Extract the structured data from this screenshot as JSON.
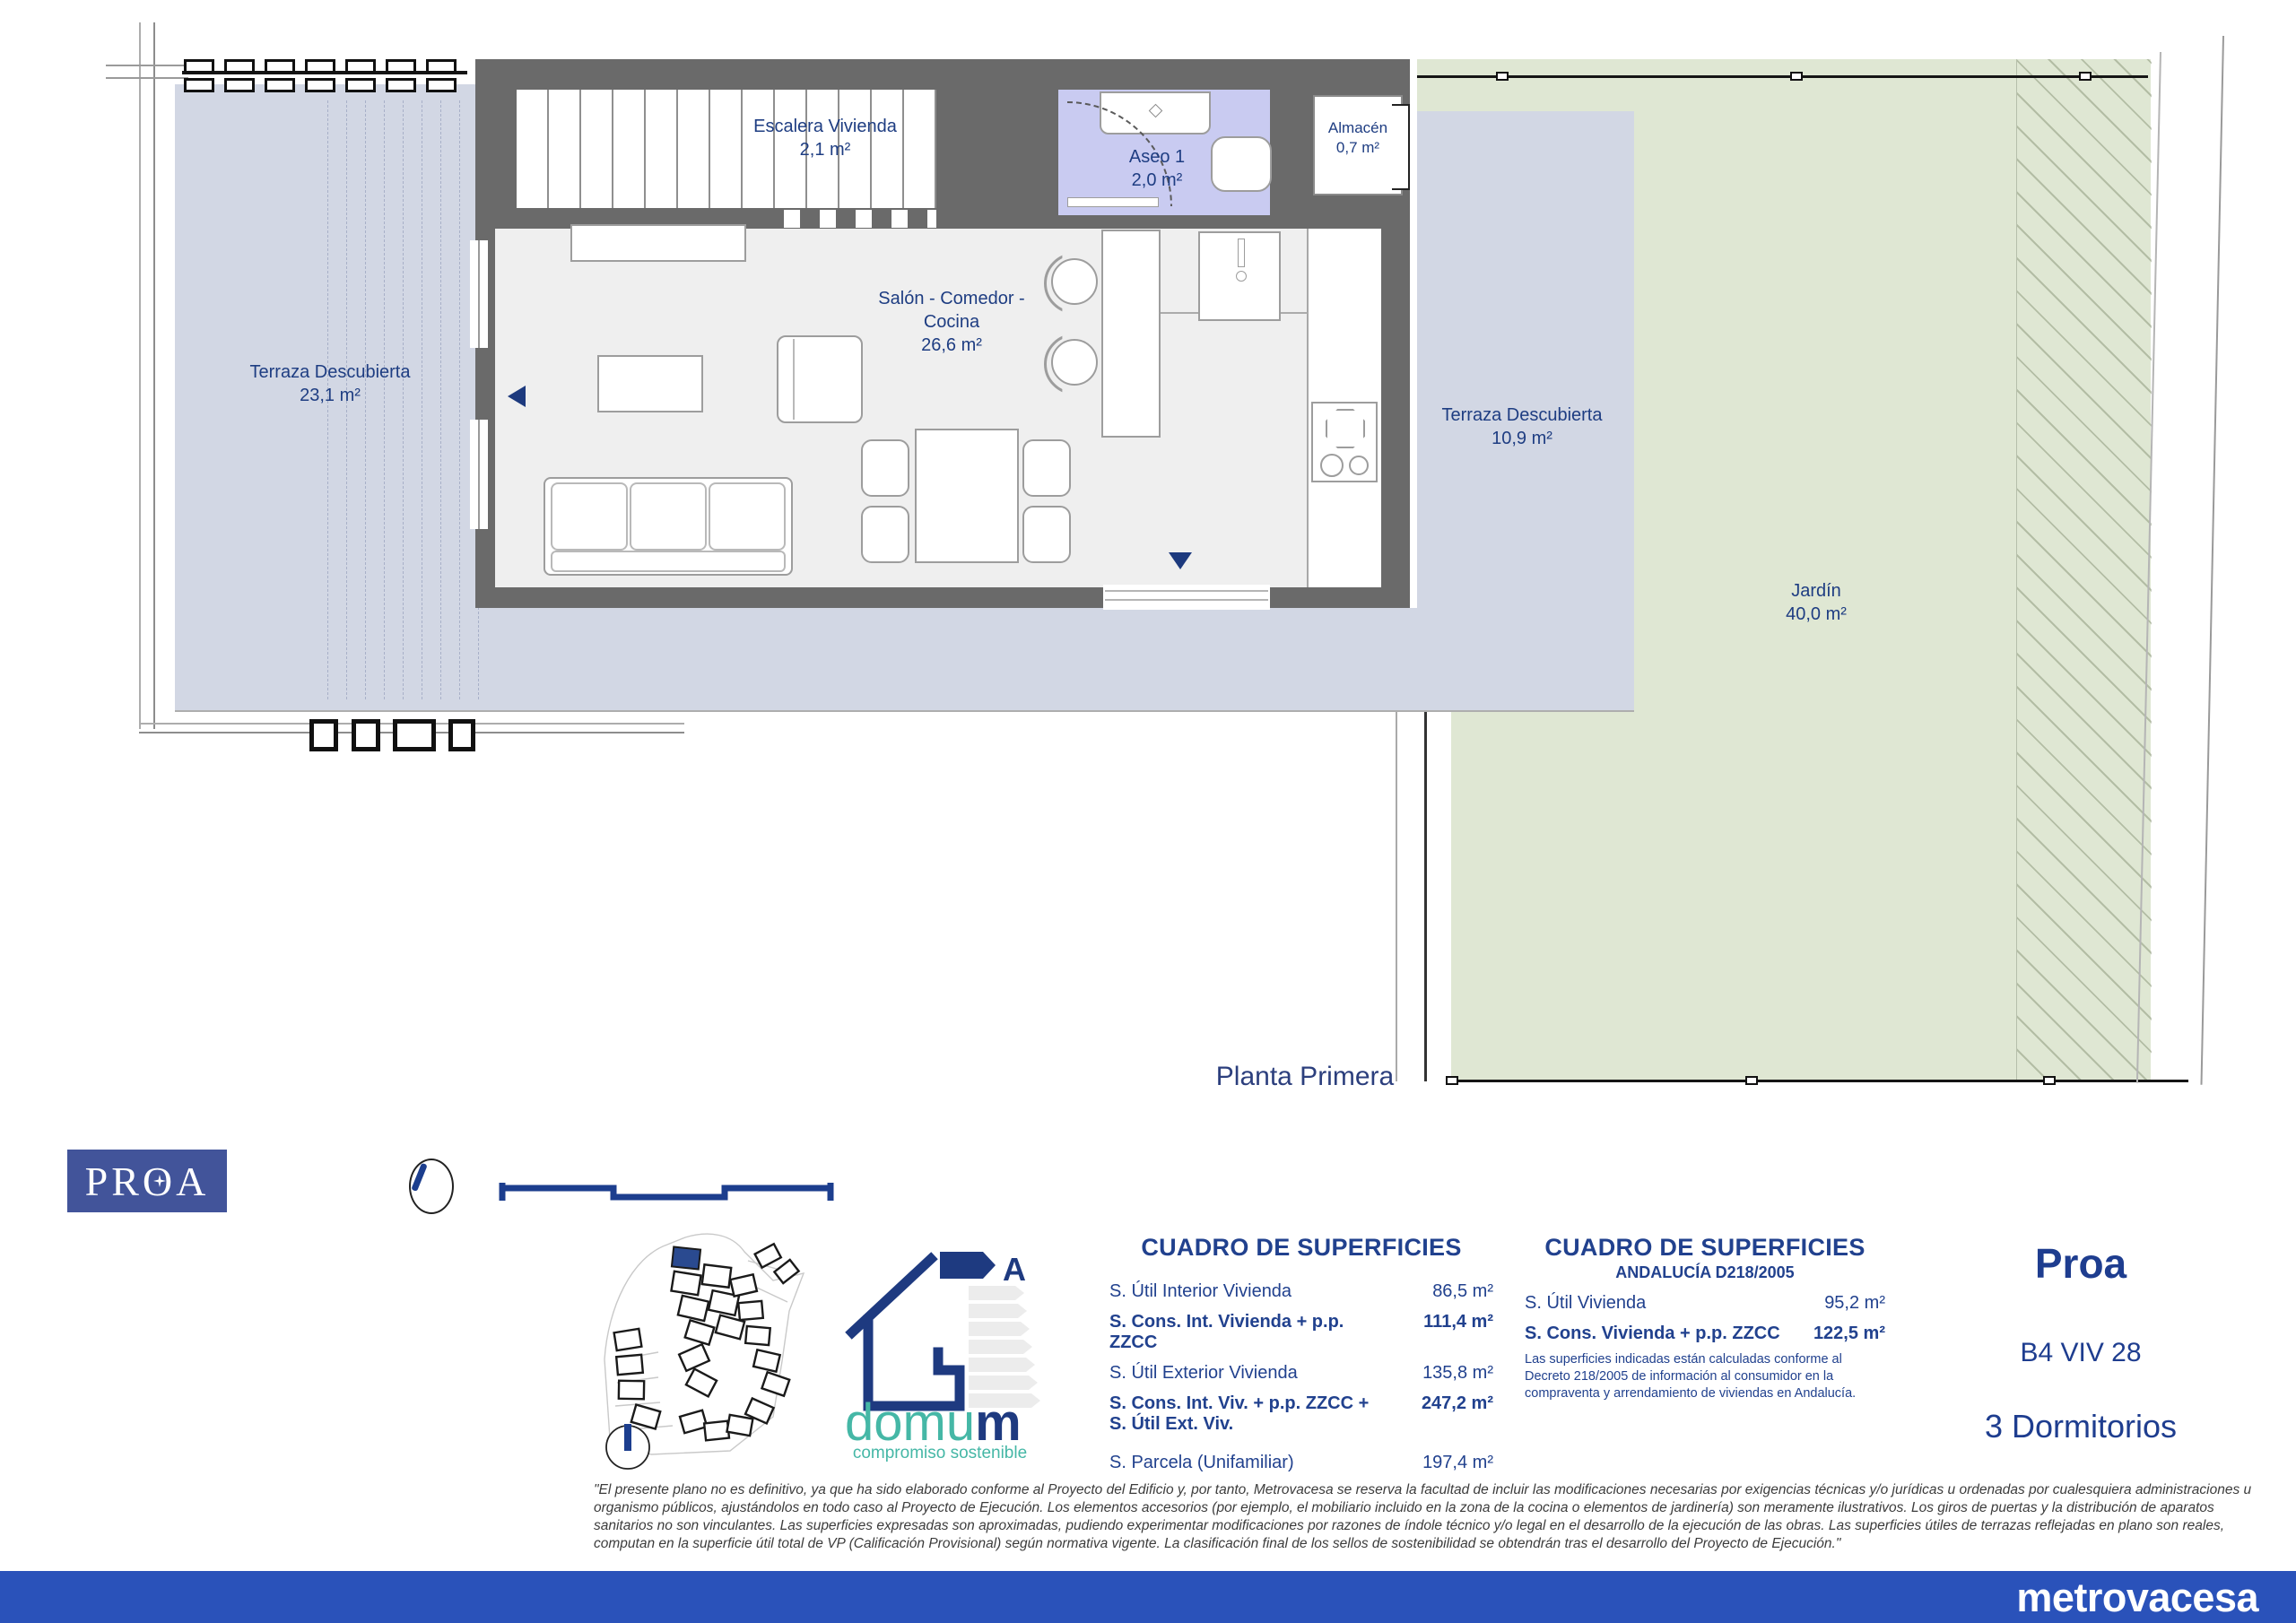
{
  "plan": {
    "floor_label": "Planta Primera",
    "rooms": {
      "terraza_left": {
        "name": "Terraza Descubierta",
        "area": "23,1 m²"
      },
      "escalera": {
        "name": "Escalera Vivienda",
        "area": "2,1 m²"
      },
      "aseo": {
        "name": "Aseo 1",
        "area": "2,0 m²"
      },
      "almacen": {
        "name": "Almacén",
        "area": "0,7 m²"
      },
      "salon": {
        "line1": "Salón - Comedor -",
        "line2": "Cocina",
        "area": "26,6 m²"
      },
      "terraza_right": {
        "name": "Terraza Descubierta",
        "area": "10,9 m²"
      },
      "jardin": {
        "name": "Jardín",
        "area": "40,0 m²"
      }
    }
  },
  "branding": {
    "proa_logo": "PROA",
    "metrovacesa": "metrovacesa",
    "domum": {
      "word_main": "domu",
      "word_last": "m",
      "tagline": "compromiso sostenible",
      "energy_label": "A"
    }
  },
  "tables": [
    {
      "title": "CUADRO DE SUPERFICIES",
      "rows": [
        {
          "label": "S. Útil Interior Vivienda",
          "value": "86,5 m²"
        },
        {
          "label": "S. Cons. Int. Vivienda + p.p. ZZCC",
          "value": "111,4 m²"
        },
        {
          "label": "S. Útil Exterior Vivienda",
          "value": "135,8 m²"
        },
        {
          "label": "S. Cons. Int. Viv. + p.p. ZZCC + S. Útil Ext. Viv.",
          "value": "247,2 m²"
        },
        {
          "label": "S. Parcela (Unifamiliar)",
          "value": "197,4 m²"
        }
      ]
    },
    {
      "title": "CUADRO DE SUPERFICIES",
      "subtitle": "ANDALUCÍA D218/2005",
      "rows": [
        {
          "label": "S. Útil Vivienda",
          "value": "95,2 m²"
        },
        {
          "label": "S. Cons. Vivienda + p.p. ZZCC",
          "value": "122,5 m²"
        }
      ],
      "note": "Las superficies indicadas están calculadas conforme al Decreto 218/2005 de información al consumidor en la compraventa y arrendamiento de viviendas en Andalucía."
    }
  ],
  "unit": {
    "project": "Proa",
    "code": "B4 VIV 28",
    "bedrooms": "3 Dormitorios"
  },
  "disclaimer": "\"El presente plano no es definitivo, ya que ha sido elaborado conforme al Proyecto del Edificio y, por tanto, Metrovacesa se reserva la facultad de incluir las modificaciones necesarias por exigencias técnicas y/o jurídicas u ordenadas por cualesquiera administraciones u organismo públicos, ajustándolos en todo caso al Proyecto de Ejecución. Los elementos accesorios (por ejemplo, el mobiliario incluido en la zona de la cocina o elementos de jardinería) son meramente ilustrativos. Los giros de puertas y la distribución de aparatos sanitarios no son vinculantes. Las superficies expresadas son aproximadas, pudiendo experimentar modificaciones por razones de índole técnico y/o legal en el desarrollo de la ejecución de las obras. Las superficies útiles de terrazas reflejadas en plano son reales, computan en la superficie útil total de VP (Calificación Provisional) según normativa vigente. La clasificación final de los sellos de sostenibilidad se obtendrán tras el desarrollo del Proyecto de Ejecución.\"",
  "colors": {
    "footer_blue": "#2a52ba",
    "plan_navy": "#1e3d82",
    "wall_gray": "#6a6a6a",
    "terrace_blue": "#d2d7e4",
    "garden_green": "#dfe7d3",
    "aseo_lavender": "#c9cbf1",
    "domum_teal": "#45b7a6",
    "proa_slate": "#42549a"
  }
}
